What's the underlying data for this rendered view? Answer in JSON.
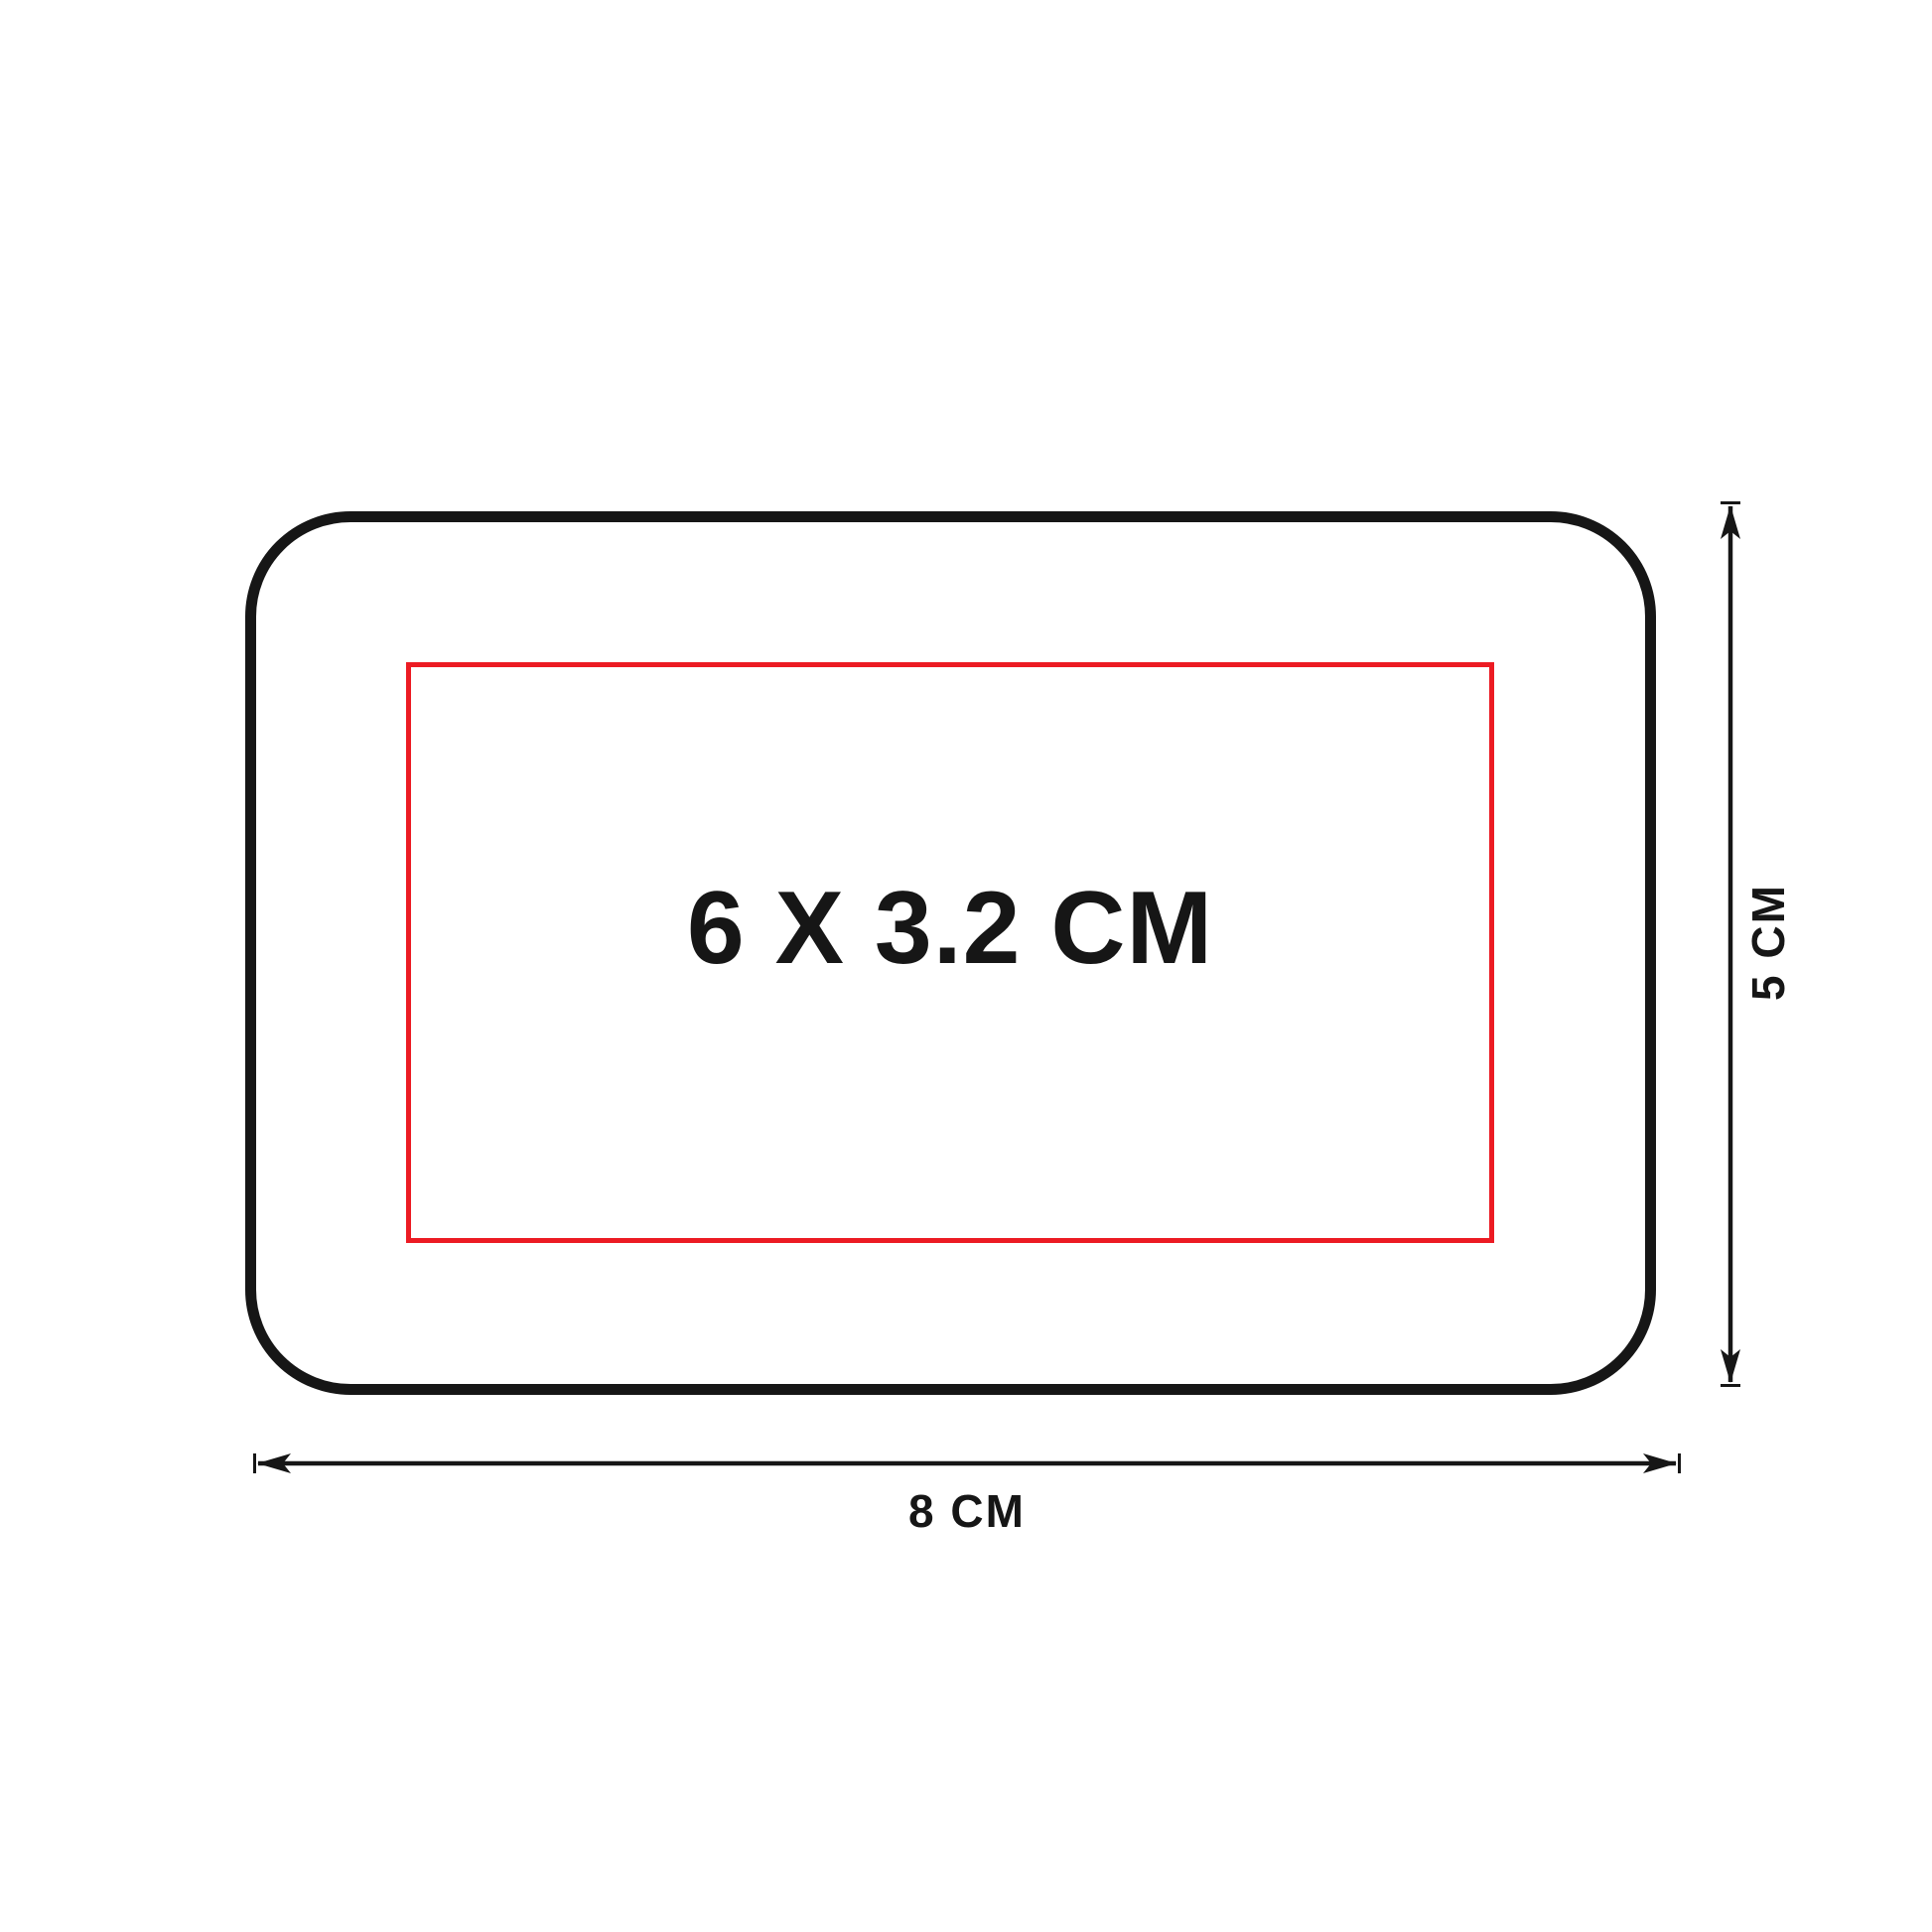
{
  "diagram": {
    "type": "print-area-specification",
    "print_area": {
      "label": "6 X 3.2 CM"
    },
    "dimensions": {
      "height_label": "5 CM",
      "width_label": "8 CM"
    }
  },
  "colors": {
    "line": "#161616",
    "red": "#ec1b23",
    "ink": "#161616",
    "bg": "#ffffff"
  }
}
